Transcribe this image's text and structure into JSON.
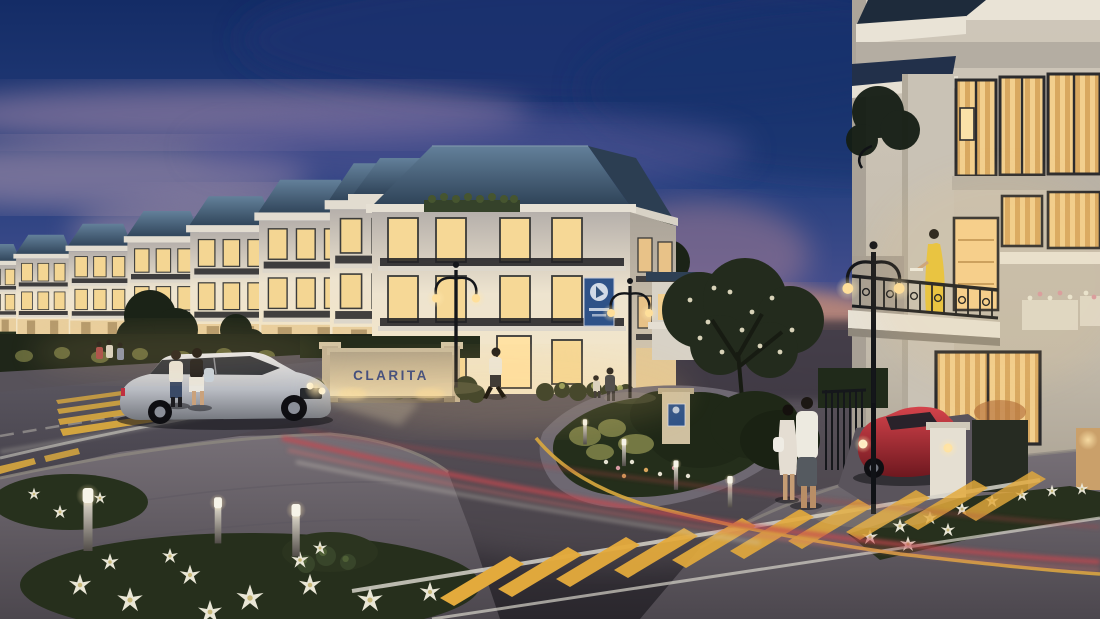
{
  "scene": {
    "description": "Twilight architectural render of a townhouse neighborhood street corner",
    "monument_sign": {
      "text": "CLARITA",
      "text_color": "#31427e",
      "wall_color": "#d9c6a0"
    },
    "banner": {
      "emblem": "round-logo",
      "color": "#2e5288"
    },
    "palette": {
      "sky_top": "#142c66",
      "sky_dusk": "#8a73a0",
      "horizon_glow": "#cb8f74",
      "roof": "#3c556e",
      "facade": "#efe6d2",
      "window_glow": "#ffd98c",
      "asphalt": "#453f46",
      "crosswalk_yellow": "#e3aa3c",
      "light_trail_red": "#c6474f",
      "foliage": "#242c1c",
      "flowers_white": "#e9e6d6",
      "car_silver": "#c3c5ca",
      "car_red": "#b22a30",
      "dress_yellow": "#e8c33c"
    }
  }
}
